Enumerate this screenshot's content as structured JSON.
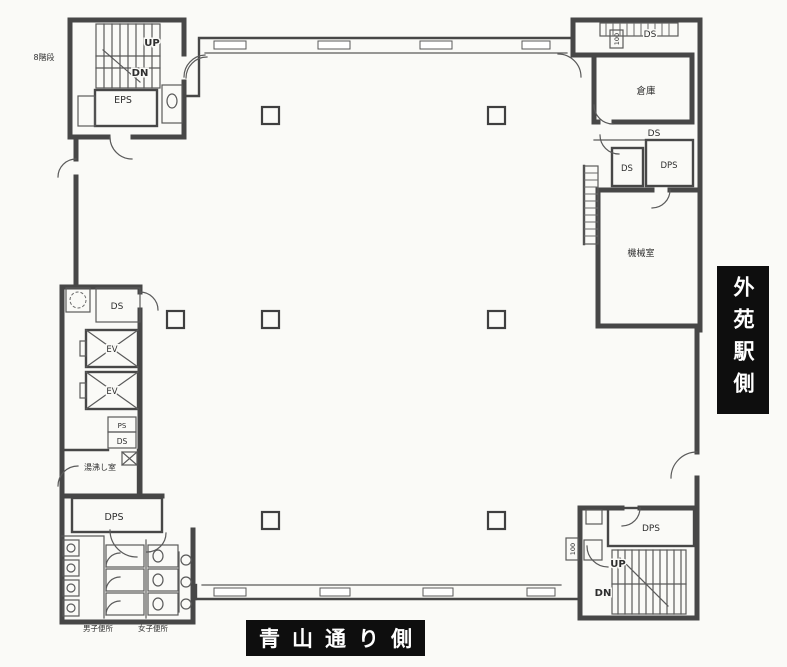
{
  "colors": {
    "ink": "#474747",
    "paper": "#fafaf7",
    "street_label_bg": "#0e0e0e",
    "street_label_text": "#ffffff"
  },
  "plan": {
    "stair_note": "8階段",
    "street_labels": {
      "right": "外苑駅側",
      "bottom": "青山通り側"
    },
    "rooms": {
      "warehouse": "倉庫",
      "machine_room": "機械室",
      "kitchenette": "湯沸し室",
      "mens_toilet": "男子便所",
      "womens_toilet": "女子便所"
    },
    "shafts": {
      "ds": "DS",
      "eps": "EPS",
      "dps": "DPS",
      "ps": "PS",
      "ev": "EV",
      "duct": "100"
    },
    "stairs": {
      "up": "UP",
      "down": "DN"
    }
  }
}
